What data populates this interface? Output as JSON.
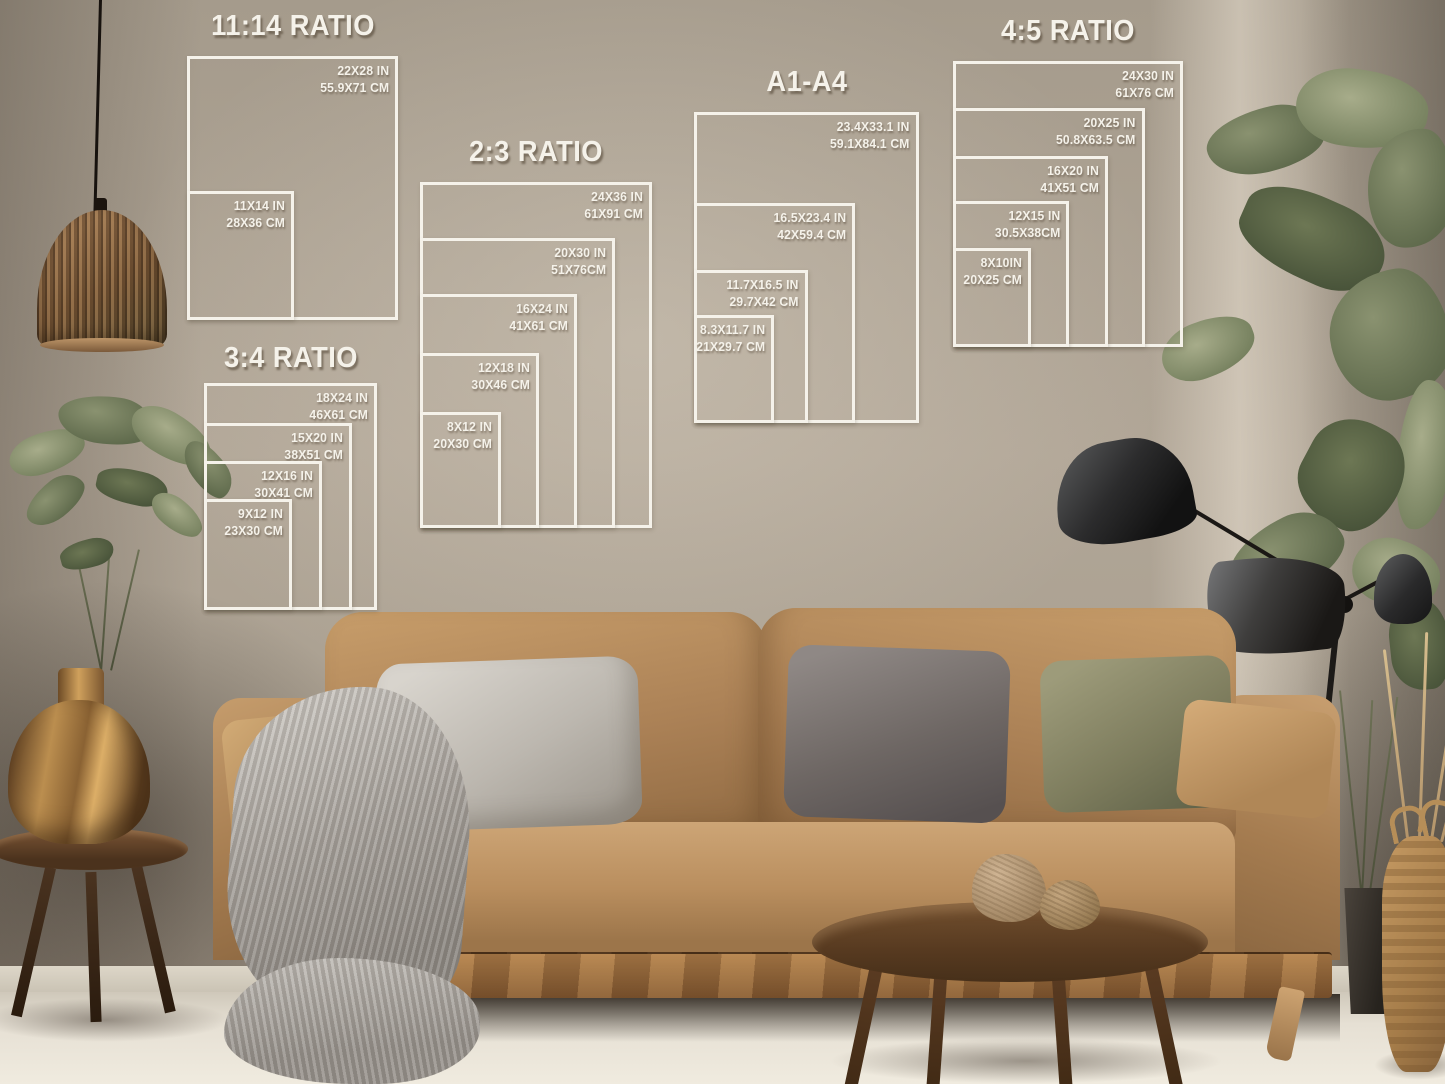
{
  "poster_guides": [
    {
      "title": "11:14 RATIO",
      "sizes": [
        {
          "inches": "22X28 IN",
          "cm": "55.9X71 CM"
        },
        {
          "inches": "11X14 IN",
          "cm": "28X36 CM"
        }
      ]
    },
    {
      "title": "2:3 RATIO",
      "sizes": [
        {
          "inches": "24X36 IN",
          "cm": "61X91 CM"
        },
        {
          "inches": "20X30 IN",
          "cm": "51X76CM"
        },
        {
          "inches": "16X24 IN",
          "cm": "41X61 CM"
        },
        {
          "inches": "12X18 IN",
          "cm": "30X46 CM"
        },
        {
          "inches": "8X12 IN",
          "cm": "20X30 CM"
        }
      ]
    },
    {
      "title": "3:4 RATIO",
      "sizes": [
        {
          "inches": "18X24 IN",
          "cm": "46X61 CM"
        },
        {
          "inches": "15X20 IN",
          "cm": "38X51 CM"
        },
        {
          "inches": "12X16 IN",
          "cm": "30X41 CM"
        },
        {
          "inches": "9X12 IN",
          "cm": "23X30 CM"
        }
      ]
    },
    {
      "title": "A1-A4",
      "sizes": [
        {
          "inches": "23.4X33.1 IN",
          "cm": "59.1X84.1 CM"
        },
        {
          "inches": "16.5X23.4 IN",
          "cm": "42X59.4 CM"
        },
        {
          "inches": "11.7X16.5 IN",
          "cm": "29.7X42 CM"
        },
        {
          "inches": "8.3X11.7 IN",
          "cm": "21X29.7 CM"
        }
      ]
    },
    {
      "title": "4:5 RATIO",
      "sizes": [
        {
          "inches": "24X30 IN",
          "cm": "61X76 CM"
        },
        {
          "inches": "20X25 IN",
          "cm": "50.8X63.5 CM"
        },
        {
          "inches": "16X20 IN",
          "cm": "41X51 CM"
        },
        {
          "inches": "12X15 IN",
          "cm": "30.5X38CM"
        },
        {
          "inches": "8X10IN",
          "cm": "20X25 CM"
        }
      ]
    }
  ],
  "palette": {
    "overlay_line": "#f5f2ea",
    "wall": "#a89e90",
    "sofa": "#b58a5d",
    "floor": "#e8e2d6",
    "wood": "#6e4b2e"
  }
}
